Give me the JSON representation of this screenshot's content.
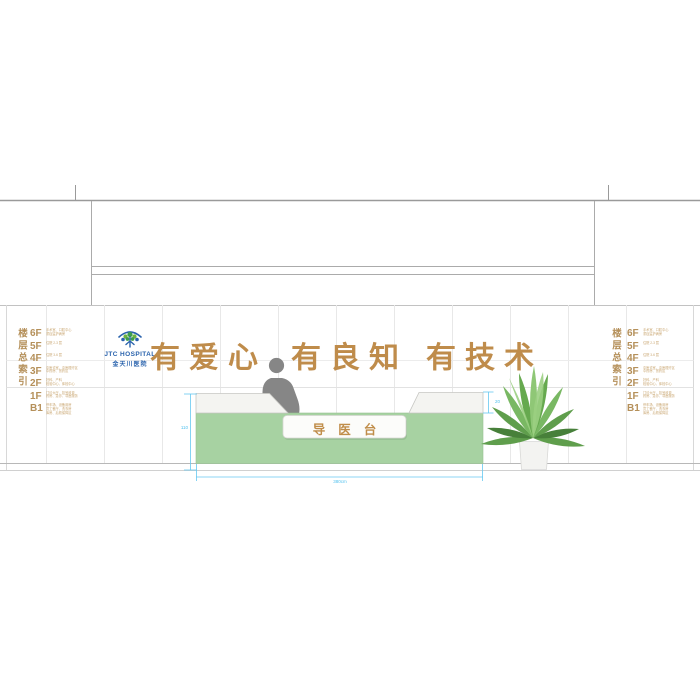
{
  "drawing": {
    "slogan": {
      "p1": "有爱心",
      "p2": "有良知",
      "p3": "有技术"
    },
    "logo": {
      "en": "JTC HOSPITAL",
      "cn": "金天川医院"
    },
    "desk": {
      "sign": "导医台"
    },
    "dimensions": {
      "height": "110",
      "counter_lip": "20",
      "width": "380cm"
    },
    "floor_index": {
      "title": "楼层总索引",
      "floors": [
        {
          "label": "6F",
          "desc": [
            "手术室、口腔中心",
            "重症监护病房"
          ]
        },
        {
          "label": "5F",
          "desc": [
            "住院 2-3 层"
          ]
        },
        {
          "label": "4F",
          "desc": [
            "住院 3-6 层"
          ]
        },
        {
          "label": "3F",
          "desc": [
            "中医诊室、中医理疗区",
            "中药房、煎药区"
          ]
        },
        {
          "label": "2F",
          "desc": [
            "妇科、产科",
            "检验中心、体检中心"
          ]
        },
        {
          "label": "1F",
          "desc": [
            "门诊大厅、挂号收费",
            "药房、急诊、导医服务"
          ]
        },
        {
          "label": "B1",
          "desc": [
            "停车场、设备用房",
            "员工餐厅、洗衣房",
            "库房、后勤保障区"
          ]
        }
      ]
    },
    "colors": {
      "accent_gold": "#bf8c4b",
      "index_tan": "#b5905a",
      "logo_blue": "#2a63ad",
      "desk_green": "#a7d2a2",
      "dimension_blue": "#5fc4ee",
      "silhouette_gray": "#868686"
    }
  }
}
